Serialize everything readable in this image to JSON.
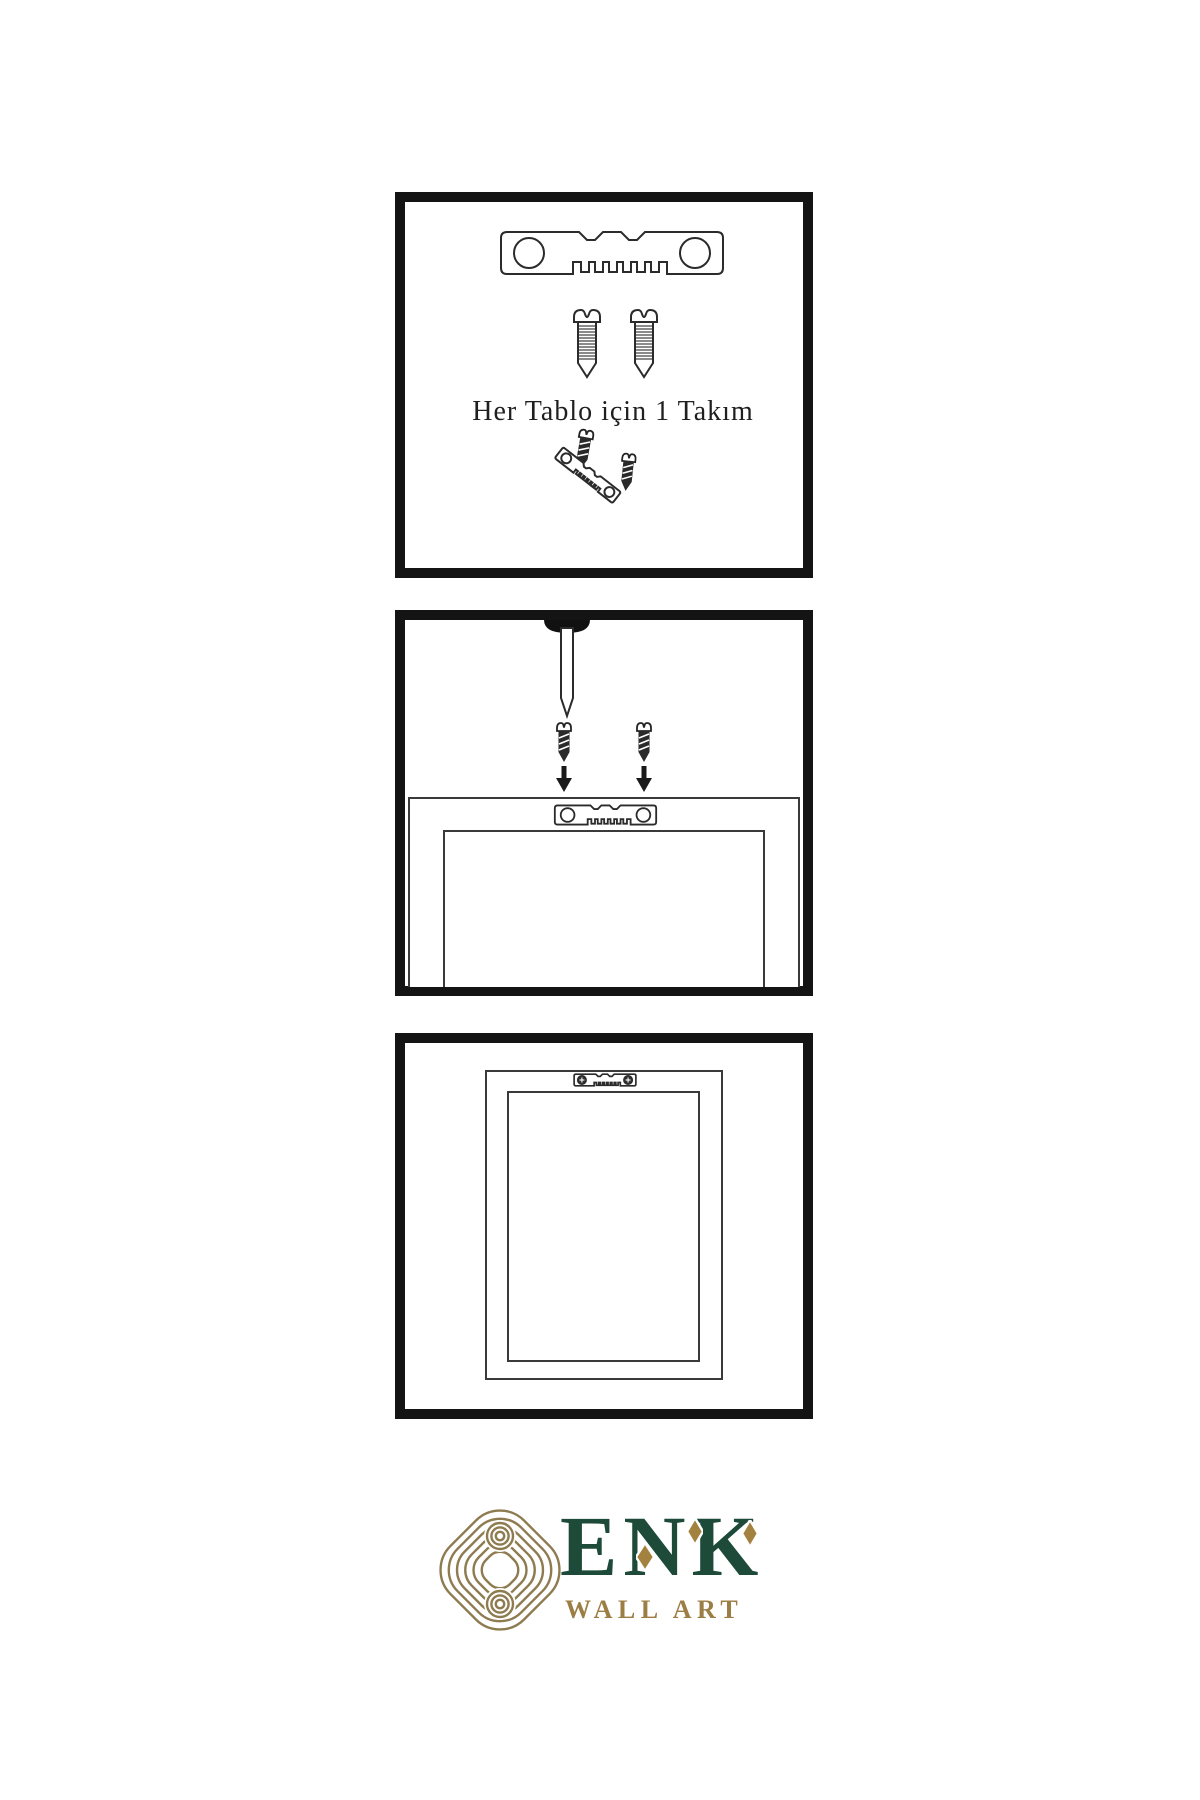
{
  "background": "#ffffff",
  "line_color": "#2b2b2b",
  "panel_border_color": "#141414",
  "step1": {
    "caption": "Her Tablo için 1 Takım",
    "items": [
      "sawtooth-hanger",
      "screw",
      "screw",
      "screw-into-tilted-hanger"
    ]
  },
  "step2": {
    "items": [
      "wall-nail",
      "dark-screw",
      "dark-screw",
      "down-arrow",
      "down-arrow",
      "frame-back-with-hanger"
    ]
  },
  "step3": {
    "items": [
      "frame-back-with-mounted-hanger"
    ]
  },
  "logo": {
    "brand": "ENK",
    "tagline": "WALL ART",
    "brand_color": "#1e4a3a",
    "gold_color": "#9c7e45",
    "knot_color": "#8e7b4f"
  }
}
